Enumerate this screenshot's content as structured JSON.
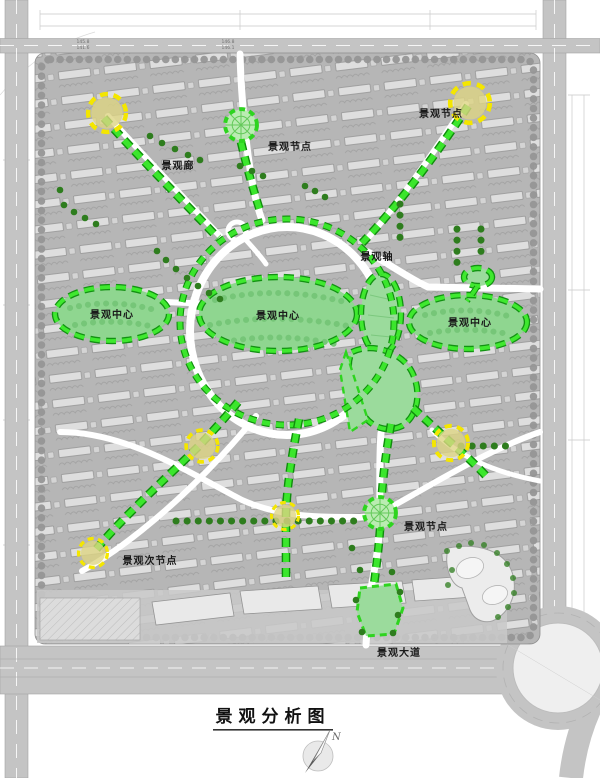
{
  "title": {
    "text": "景观分析图"
  },
  "compass": {
    "north_label": "N"
  },
  "labels": {
    "center": "景观中心",
    "node": "景观节点",
    "sub_node": "景观次节点",
    "corridor": "景观廊",
    "axis": "景观轴",
    "avenue": "景观大道"
  },
  "road_elevations": [
    "145.8",
    "141.6",
    "146.8",
    "146.1"
  ],
  "colors": {
    "path_green_bright": "#3be62c",
    "path_green_dark": "#0f8c0c",
    "center_green_fill": "#8fd690",
    "node_yellow": "#f4e600",
    "node_yellow_fill": "#ddd583",
    "tree_dark_green": "#2e7d1e",
    "road_gray": "#c4c4c4",
    "site_gray": "#b6b6b6"
  }
}
